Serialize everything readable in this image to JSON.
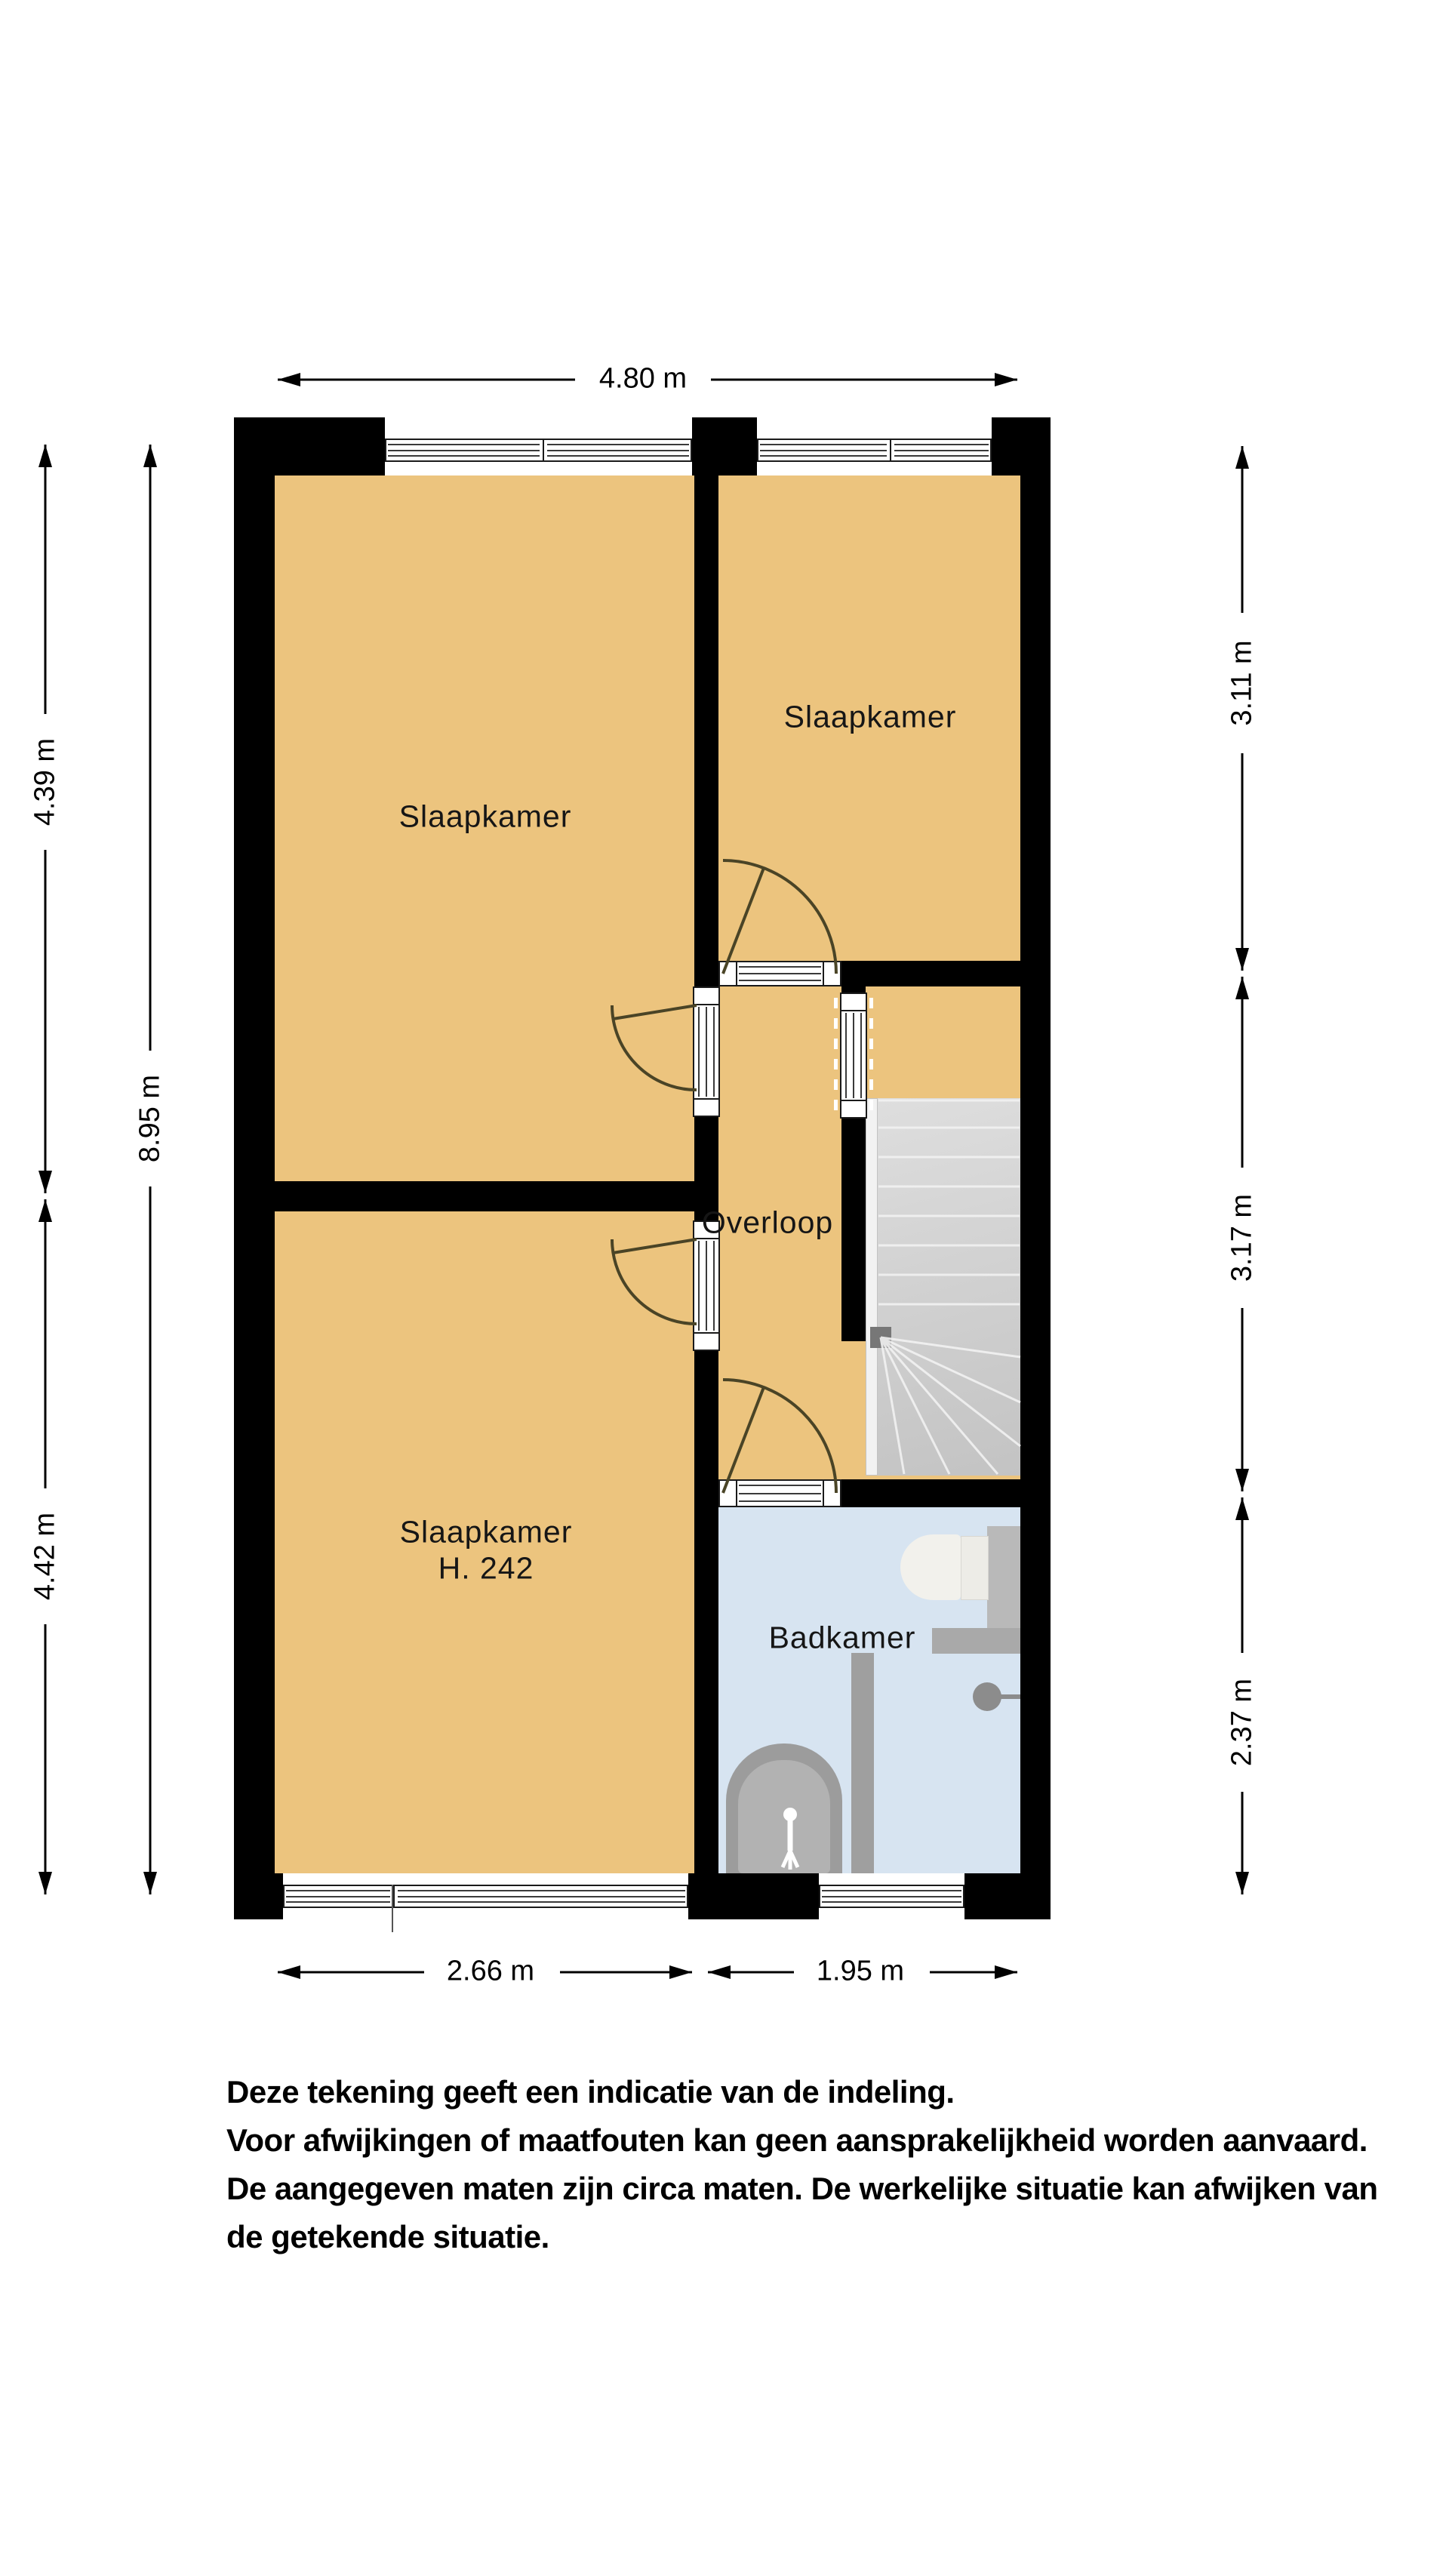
{
  "plan": {
    "rooms": [
      {
        "id": "bedroom-top-left",
        "label": "Slaapkamer"
      },
      {
        "id": "bedroom-top-right",
        "label": "Slaapkamer"
      },
      {
        "id": "bedroom-bottom-left",
        "label": "Slaapkamer",
        "sublabel": "H. 242"
      },
      {
        "id": "landing",
        "label": "Overloop"
      },
      {
        "id": "bathroom",
        "label": "Badkamer"
      }
    ],
    "dimensions": {
      "top": "4.80 m",
      "left_upper": "4.39 m",
      "left_total": "8.95 m",
      "left_lower": "4.42 m",
      "right_upper": "3.11 m",
      "right_middle": "3.17 m",
      "right_lower": "2.37 m",
      "bottom_left": "2.66 m",
      "bottom_right": "1.95 m"
    },
    "colors": {
      "wall": "#000000",
      "floor": "#ecc47e",
      "bathroom_floor": "#d7e4f1",
      "stairs": "#d2d2d2",
      "door_arc": "#4a4426"
    }
  },
  "disclaimer": {
    "lines": [
      "Deze tekening geeft een indicatie van de indeling.",
      "Voor  afwijkingen of maatfouten kan geen aansprakelijkheid worden aanvaard.",
      "De aangegeven maten zijn circa maten. De werkelijke situatie kan afwijken van",
      "de getekende situatie."
    ]
  }
}
